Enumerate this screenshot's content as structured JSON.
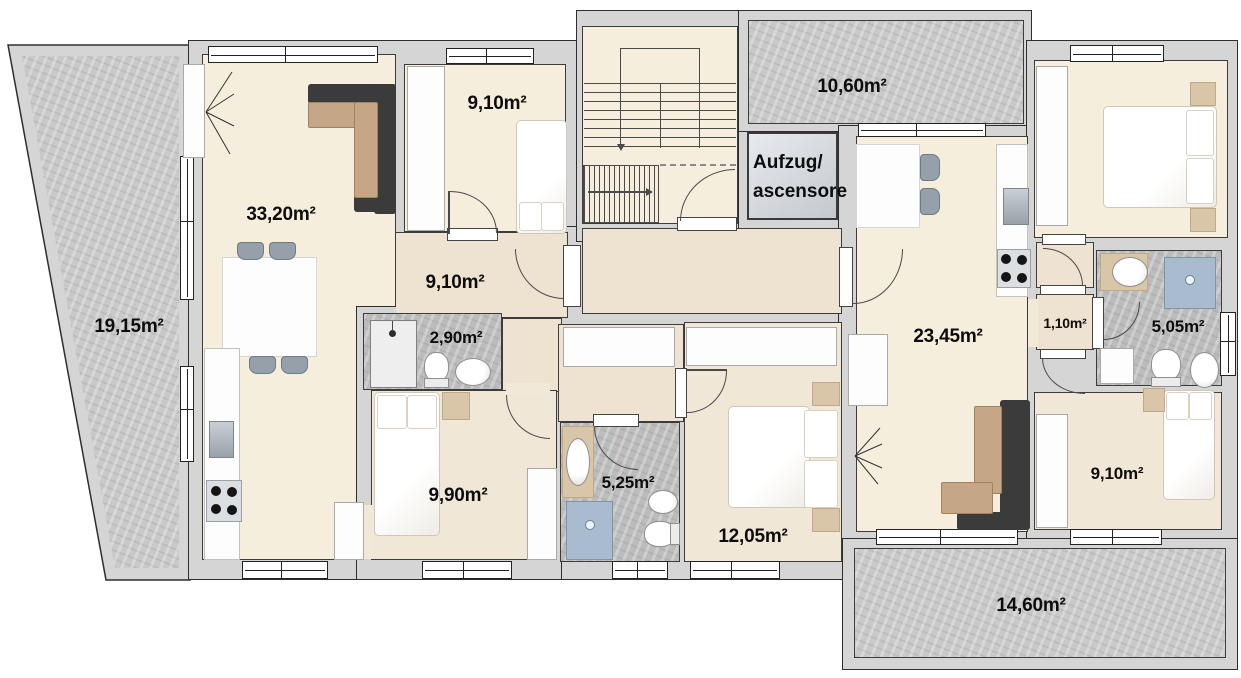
{
  "plan": {
    "elevator": {
      "line1": "Aufzug/",
      "line2": "ascensore"
    },
    "rooms": {
      "balcony_left": "19,15m²",
      "living_left": "33,20m²",
      "bedroom_top_left": "9,10m²",
      "hall_left": "9,10m²",
      "bath_small": "2,90m²",
      "bedroom_mid_left": "9,90m²",
      "bath_mid": "5,25m²",
      "bedroom_center": "12,05m²",
      "balcony_top_right": "10,60m²",
      "living_right": "23,45m²",
      "closet_right": "1,10m²",
      "bath_right": "5,05m²",
      "bedroom_bottom_right": "9,10m²",
      "balcony_bottom_right": "14,60m²"
    },
    "colors": {
      "wall": "#d5d5d5",
      "floor": "#f6eedd",
      "balcony": "#c9c9c9",
      "bath_floor": "#bcbcbc",
      "sofa_dark": "#3b3b3b",
      "sofa_tan": "#c5a687",
      "shower_blue": "#a9bccf"
    }
  }
}
